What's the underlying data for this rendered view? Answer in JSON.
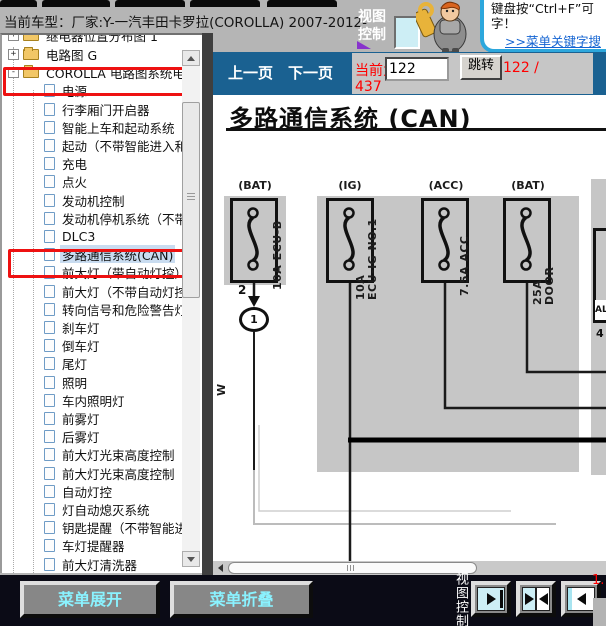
{
  "colors": {
    "nav_blue": "#1a6191",
    "annotation_red": "#ee1111",
    "status_red": "#ff0000",
    "selection_blue": "#c9dcf0",
    "scan_gray": "#c6c6c6",
    "bottom_bar": "#0b0b16",
    "button_text_cyan": "#8af2ff",
    "link_blue": "#1464d2"
  },
  "title_bar": {
    "vehicle_label": "当前车型：厂家:Y-一汽丰田卡罗拉(COROLLA) 2007-2012-",
    "view_control": "视图控制"
  },
  "helper": {
    "tip_line1": "键盘按“Ctrl+F”可",
    "tip_line2": "字！",
    "link_text": ">>菜单关键字搜"
  },
  "tree": {
    "clipped_item": "继电器位置分布图 1",
    "items": [
      {
        "type": "folder",
        "expand": "+",
        "label": "电路图 G"
      },
      {
        "type": "folder",
        "expand": "-",
        "label": "COROLLA 电路图系统电路",
        "redbox": true
      },
      {
        "type": "doc",
        "label": "电源"
      },
      {
        "type": "doc",
        "label": "行李厢门开启器"
      },
      {
        "type": "doc",
        "label": "智能上车和起动系统"
      },
      {
        "type": "doc",
        "label": "起动（不带智能进入和起"
      },
      {
        "type": "doc",
        "label": "充电"
      },
      {
        "type": "doc",
        "label": "点火"
      },
      {
        "type": "doc",
        "label": "发动机控制"
      },
      {
        "type": "doc",
        "label": "发动机停机系统（不带智"
      },
      {
        "type": "doc",
        "label": "DLC3"
      },
      {
        "type": "doc",
        "label": "多路通信系统(CAN)",
        "selected": true,
        "redbox": true
      },
      {
        "type": "doc",
        "label": "前大灯（带自动灯控）"
      },
      {
        "type": "doc",
        "label": "前大灯（不带自动灯控）"
      },
      {
        "type": "doc",
        "label": "转向信号和危险警告灯"
      },
      {
        "type": "doc",
        "label": "刹车灯"
      },
      {
        "type": "doc",
        "label": "倒车灯"
      },
      {
        "type": "doc",
        "label": "尾灯"
      },
      {
        "type": "doc",
        "label": "照明"
      },
      {
        "type": "doc",
        "label": "车内照明灯"
      },
      {
        "type": "doc",
        "label": "前雾灯"
      },
      {
        "type": "doc",
        "label": "后雾灯"
      },
      {
        "type": "doc",
        "label": "前大灯光束高度控制（自"
      },
      {
        "type": "doc",
        "label": "前大灯光束高度控制（手"
      },
      {
        "type": "doc",
        "label": "自动灯控"
      },
      {
        "type": "doc",
        "label": "灯自动熄灭系统"
      },
      {
        "type": "doc",
        "label": "钥匙提醒（不带智能进入"
      },
      {
        "type": "doc",
        "label": "车灯提醒器"
      },
      {
        "type": "doc",
        "label": "前大灯清洗器"
      }
    ]
  },
  "nav": {
    "prev": "上一页",
    "next": "下一页",
    "current_label": "当前为",
    "page_value": "122",
    "jump": "跳转",
    "page_of": "122 /",
    "page_total": "437"
  },
  "diagram": {
    "title": "多路通信系统 (CAN)",
    "fuses": [
      {
        "head": "(BAT)",
        "label": "10A ECU-B"
      },
      {
        "head": "(IG)",
        "label": "10A\nECU-IG NO.1"
      },
      {
        "head": "(ACC)",
        "label": "7.5A ACC"
      },
      {
        "head": "(BAT)",
        "label": "25A DOOR"
      }
    ],
    "connector_pin": "2",
    "connector_id": "1",
    "wire_color": "W",
    "partial_box_label": "AL",
    "partial_box_pin": "4"
  },
  "bottom": {
    "expand_menu": "菜单展开",
    "collapse_menu": "菜单折叠",
    "view_control": "视图控制",
    "zoom_indicator": "1."
  }
}
